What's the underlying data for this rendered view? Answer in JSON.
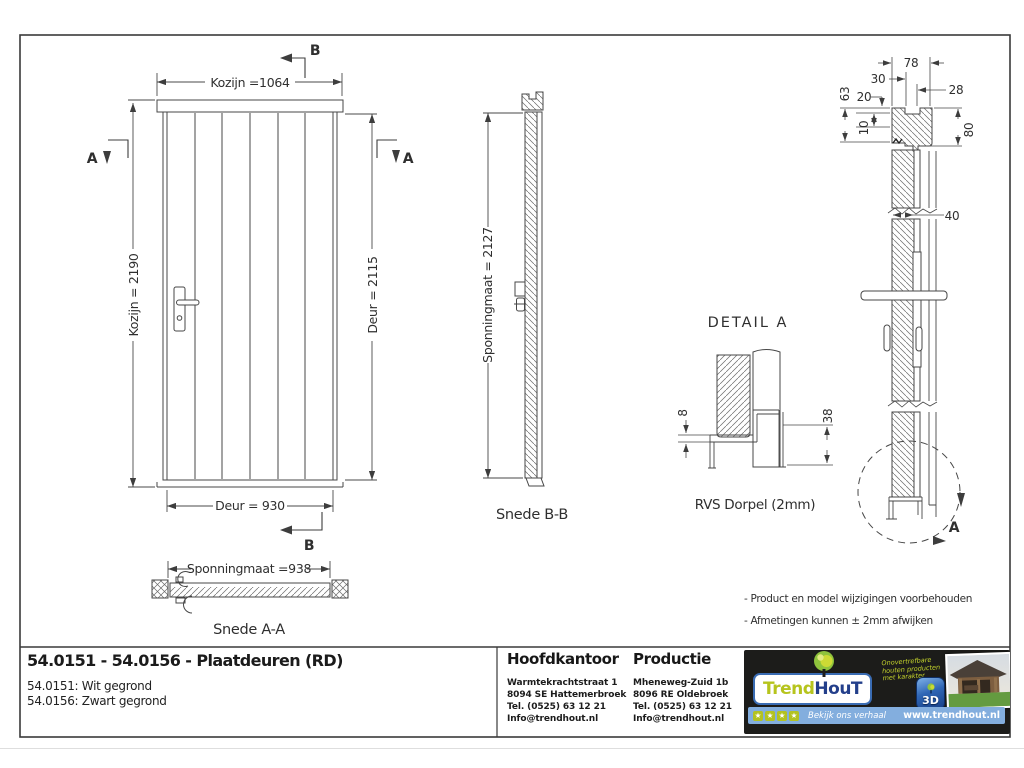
{
  "drawing": {
    "front": {
      "dim_top": "Kozijn =1064",
      "dim_left": "Kozijn = 2190",
      "dim_right": "Deur = 2115",
      "dim_bottom": "Deur = 930",
      "cut_b_top": "B",
      "cut_b_bottom": "B",
      "cut_a_left": "A",
      "cut_a_right": "A"
    },
    "snede_aa": {
      "dim": "Sponningmaat =938",
      "label": "Snede A-A"
    },
    "snede_bb": {
      "dim": "Sponningmaat = 2127",
      "label": "Snede B-B"
    },
    "detail_a": {
      "title": "DETAIL A",
      "dim_8": "8",
      "dim_38": "38",
      "caption": "RVS Dorpel (2mm)"
    },
    "side": {
      "d78": "78",
      "d30": "30",
      "d28": "28",
      "d63": "63",
      "d20": "20",
      "d10": "10",
      "d80": "80",
      "d40": "40",
      "detail_ref": "A"
    },
    "notes": [
      "- Product en model wijzigingen voorbehouden",
      "- Afmetingen kunnen ± 2mm afwijken"
    ]
  },
  "title_block": {
    "title": "54.0151 - 54.0156 - Plaatdeuren (RD)",
    "sub1": "54.0151: Wit gegrond",
    "sub2": "54.0156: Zwart gegrond",
    "hoofdkantoor": {
      "heading": "Hoofdkantoor",
      "lines": [
        "Warmtekrachtstraat 1",
        "8094 SE Hattemerbroek",
        "Tel. (0525) 63 12 21",
        "Info@trendhout.nl"
      ]
    },
    "productie": {
      "heading": "Productie",
      "lines": [
        "Mheneweg-Zuid 1b",
        "8096 RE Oldebroek",
        "Tel. (0525) 63 12 21",
        "Info@trendhout.nl"
      ]
    }
  },
  "brand": {
    "logo_trend": "Trend",
    "logo_hout": "HouT",
    "slogan": [
      "Onovertrefbare",
      "houten producten",
      "met karakter"
    ],
    "icon_3d": "3D",
    "star": "★",
    "strip_text": "Bekijk ons verhaal",
    "website": "www.trendhout.nl",
    "colors": {
      "logo_green": "#b6c41d",
      "logo_blue": "#233f8b",
      "strip_blue": "#83aede",
      "box_black": "#1c1c1a"
    }
  }
}
